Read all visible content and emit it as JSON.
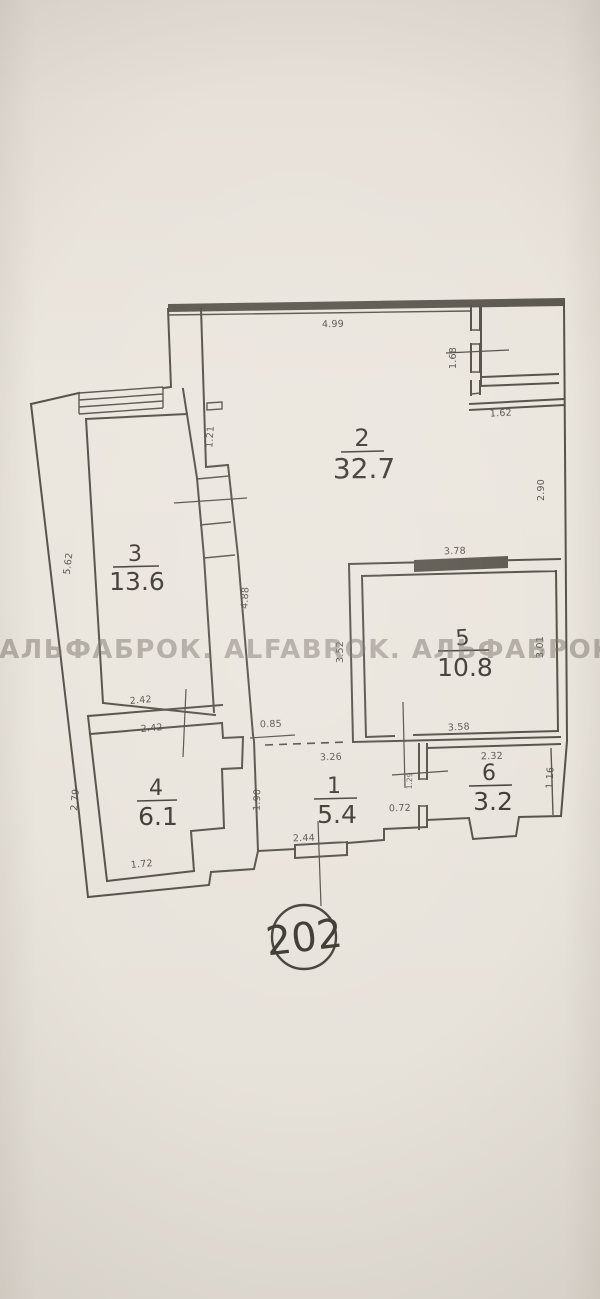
{
  "meta": {
    "apartment_number": "202",
    "watermark": "АЛЬФАБРОК. ALFABROK. АЛЬФАБРОК"
  },
  "rooms": [
    {
      "id": "2",
      "area": "32.7"
    },
    {
      "id": "3",
      "area": "13.6"
    },
    {
      "id": "5",
      "area": "10.8"
    },
    {
      "id": "4",
      "area": "6.1"
    },
    {
      "id": "1",
      "area": "5.4"
    },
    {
      "id": "6",
      "area": "3.2"
    }
  ],
  "dimensions": [
    {
      "value": "4.99"
    },
    {
      "value": "1.68"
    },
    {
      "value": "1.62"
    },
    {
      "value": "2.90"
    },
    {
      "value": "3.78"
    },
    {
      "value": "3.52"
    },
    {
      "value": "3.01"
    },
    {
      "value": "3.58"
    },
    {
      "value": "1.21"
    },
    {
      "value": "4.88"
    },
    {
      "value": "5.62"
    },
    {
      "value": "2.42"
    },
    {
      "value": "2.42"
    },
    {
      "value": "2.79"
    },
    {
      "value": "1.72"
    },
    {
      "value": "0.85"
    },
    {
      "value": "3.26"
    },
    {
      "value": "1.90"
    },
    {
      "value": "2.44"
    },
    {
      "value": "0.72"
    },
    {
      "value": "1.29"
    },
    {
      "value": "2.32"
    },
    {
      "value": "1.16"
    }
  ]
}
